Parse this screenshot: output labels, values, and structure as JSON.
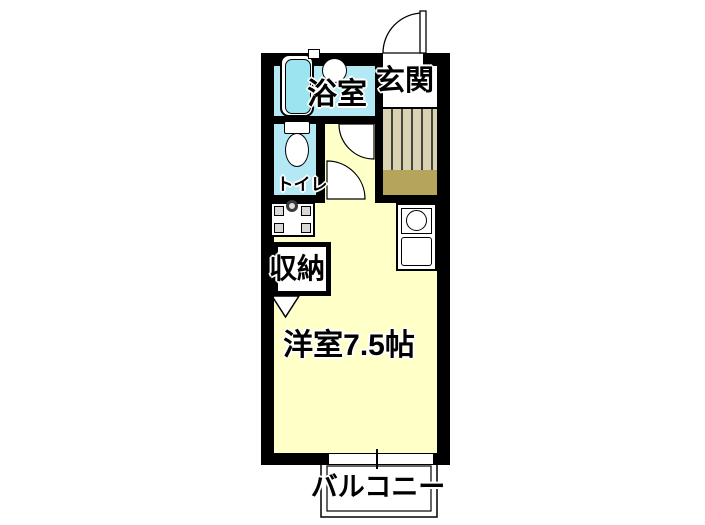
{
  "plan": {
    "rooms": {
      "bathroom": "浴室",
      "entrance": "玄関",
      "toilet": "トイレ",
      "storage": "収納",
      "western_room": "洋室7.5帖",
      "balcony": "バルコニー"
    },
    "colors": {
      "wall": "#000000",
      "room_floor": "#ffffc8",
      "wet_area_floor": "#b3e9f5",
      "bathtub_water": "#9ce4f0",
      "entrance_wood_floor": "#d9d2b3",
      "entrance_mat": "#b5a45c"
    }
  }
}
